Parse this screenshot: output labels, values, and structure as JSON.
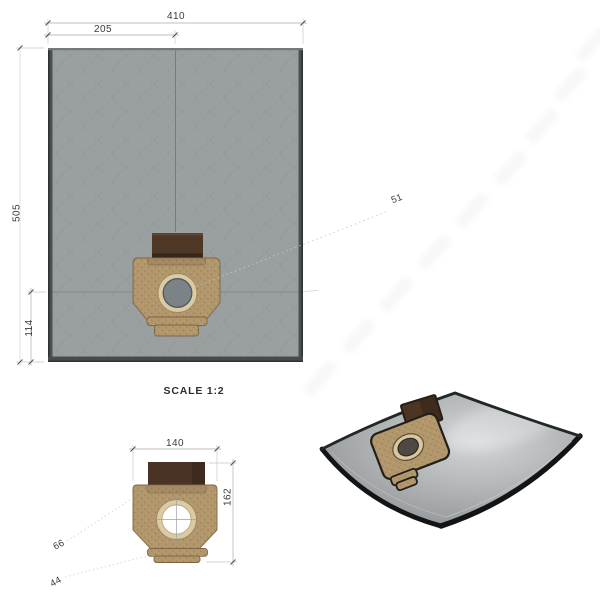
{
  "drawing": {
    "scale_label": "SCALE 1:2",
    "flat_view": {
      "dim_width": "410",
      "dim_half_width": "205",
      "dim_height": "505",
      "dim_bottom_offset": "114",
      "dim_leader": "51"
    },
    "detail_view": {
      "dim_width": "140",
      "dim_height": "162",
      "dim_upper": "66",
      "dim_lower": "44"
    },
    "colors": {
      "bag_fill": "#9aa0a0",
      "bag_edge_dark": "#43474a",
      "plate_tan": "#b2966c",
      "collar_brown": "#4c3523",
      "ring_cream": "#dbcaa3",
      "hole_gray": "#7b8387",
      "dim_line": "#a8abac",
      "dim_text": "#3b3b3b"
    }
  }
}
